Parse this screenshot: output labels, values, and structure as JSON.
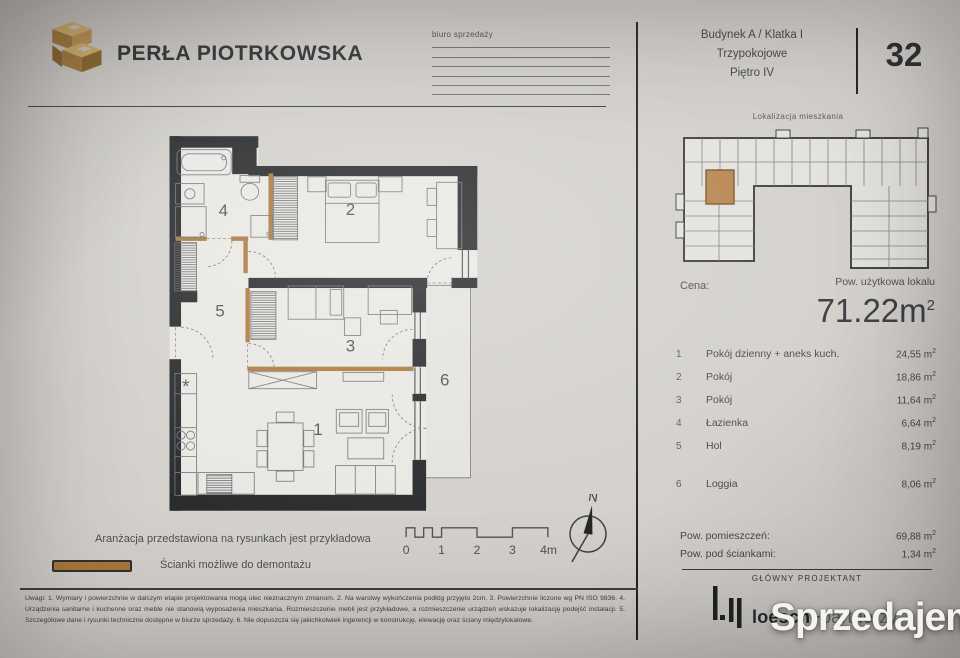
{
  "brand": {
    "name": "PERŁA PIOTRKOWSKA"
  },
  "sales_office": {
    "label": "biuro sprzedaży"
  },
  "unit_header": {
    "building": "Budynek A / Klatka I",
    "rooms_type": "Trzypokojowe",
    "floor": "Piętro IV",
    "number": "32"
  },
  "location_map": {
    "label": "Lokalizacja mieszkania"
  },
  "price": {
    "label": "Cena:"
  },
  "usable_area": {
    "label": "Pow. użytkowa lokalu",
    "value": "71.22m",
    "sup": "2"
  },
  "room_list": {
    "sup": "2",
    "items": [
      {
        "no": "1",
        "name": "Pokój dzienny + aneks kuch.",
        "area": "24,55 m"
      },
      {
        "no": "2",
        "name": "Pokój",
        "area": "18,86 m"
      },
      {
        "no": "3",
        "name": "Pokój",
        "area": "11,64 m"
      },
      {
        "no": "4",
        "name": "Łazienka",
        "area": "6,64 m"
      },
      {
        "no": "5",
        "name": "Hol",
        "area": "8,19 m"
      },
      {
        "no": "6",
        "name": "Loggia",
        "area": "8,06 m"
      }
    ]
  },
  "totals": {
    "sup": "2",
    "rows": [
      {
        "label": "Pow. pomieszczeń:",
        "value": "69,88 m"
      },
      {
        "label": "Pow. pod ściankami:",
        "value": "1,34 m"
      }
    ]
  },
  "designer": {
    "label": "GŁÓWNY PROJEKTANT",
    "name_bold": "loesch",
    "name_light": "+partnerzy"
  },
  "plan": {
    "labels": [
      "1",
      "2",
      "3",
      "4",
      "5",
      "6"
    ],
    "legend_note": "Aranżacja przedstawiona na rysunkach jest przykładowa",
    "legend_demolition": "Ścianki możliwe do demontażu"
  },
  "scale_bar": {
    "labels": [
      "0",
      "1",
      "2",
      "3",
      "4m"
    ]
  },
  "compass": {
    "north": "N"
  },
  "disclaimer": "Uwagi: 1. Wymiary i powierzchnie w dalszym etapie projektowania mogą ulec nieznacznym zmianom. 2. Na warstwy wykończenia podłóg przyjęto 2cm. 3. Powierzchnie liczone wg PN ISO 9836. 4. Urządzenia sanitarne i kuchenne oraz meble nie stanowią wyposażenia mieszkania. Rozmieszczenie mebli jest przykładowe, a rozmieszczenie urządzeń wskazuje lokalizację podejść instalacji. 5. Szczegółowe dane i rysunki techniczne dostępne w biurze sprzedaży. 6. Nie dopuszcza się jakichkolwiek ingerencji w konstrukcję, elewację oraz ściany międzylokalowe.",
  "watermark": {
    "text": "Sprzedajemy",
    "tld": "pl"
  },
  "colors": {
    "demolition_wall": "#a9763a",
    "wall": "#212325",
    "highlight_unit": "#b5824a",
    "watermark_red": "#d5202a"
  }
}
